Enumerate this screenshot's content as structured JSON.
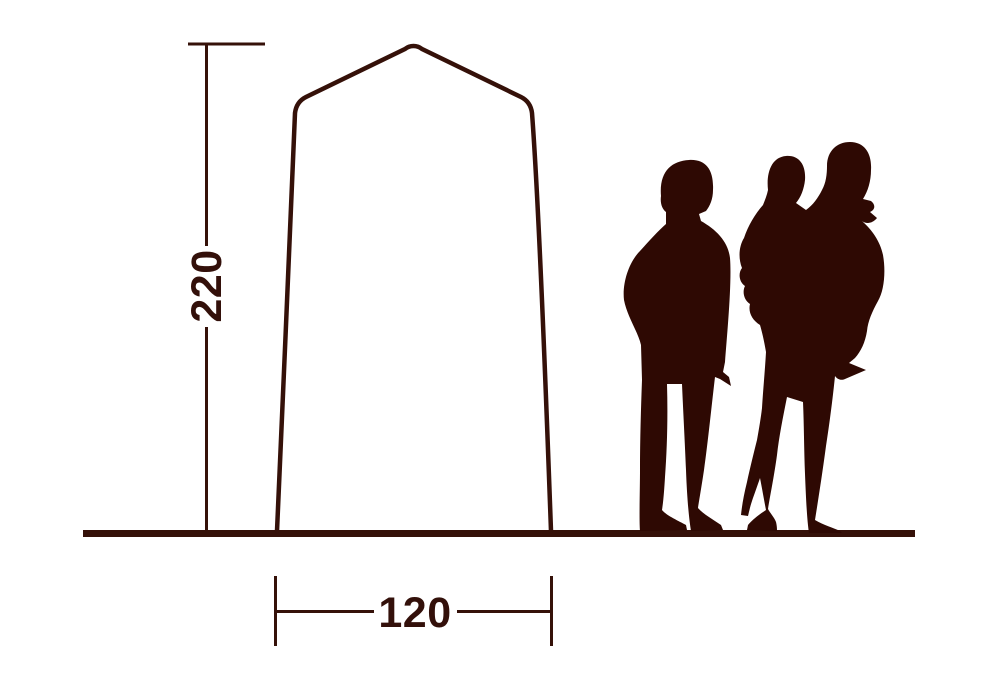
{
  "canvas": {
    "width": 995,
    "height": 682,
    "background": "#ffffff"
  },
  "colors": {
    "silhouette": "#2e0903",
    "line": "#351109",
    "text": "#33100a"
  },
  "diagram": {
    "type": "tent-dimension-diagram",
    "height_label": "220",
    "width_label": "120",
    "figures": [
      "adult-silhouette",
      "adult-carrying-child-silhouette"
    ]
  }
}
